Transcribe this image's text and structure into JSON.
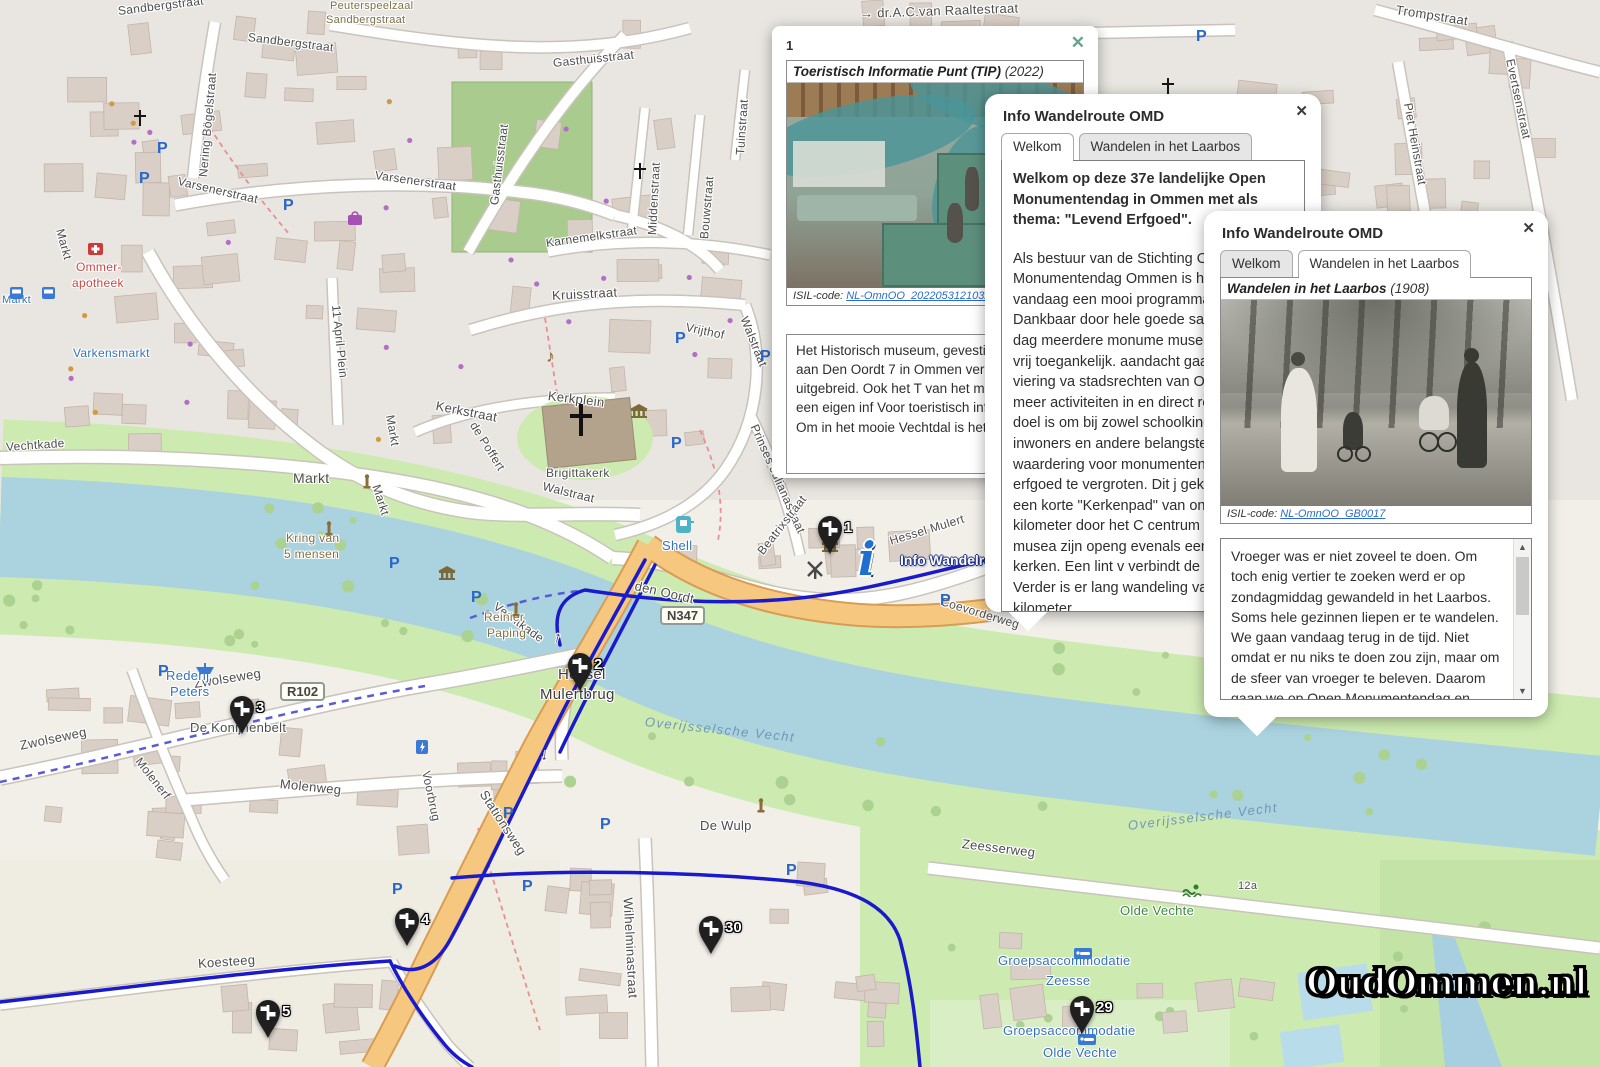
{
  "colors": {
    "route_blue": "#1a1acd",
    "road_orange": "#f6c87f",
    "water": "#aad3df",
    "marker_black": "#1f1f1f",
    "link_blue": "#2a6bd4"
  },
  "popup1": {
    "index": "1",
    "close": "✕",
    "title": "Toeristisch Informatie Punt (TIP)",
    "year": "(2022)",
    "isil_label": "ISIL-code:",
    "isil_link": "NL-OmnOO_20220531210327",
    "body": "Het Historisch museum, gevestigd i tolhuis aan Den Oordt 7 in Ommen vernieuwd en uitgebreid. Ook het T van het museum met een eigen inf Voor toeristisch informatie over Om in het mooie Vechtdal is het TIP de"
  },
  "popup2": {
    "title": "Info Wandelroute OMD",
    "close": "✕",
    "tabs": [
      "Welkom",
      "Wandelen in het Laarbos"
    ],
    "intro": "Welkom op deze 37e landelijke Open Monumentendag in Ommen met als thema: \"Levend Erfgoed\".",
    "body": "Als bestuur van de Stichting Open Monumentendag Ommen is het ons voor vandaag een mooi programma stellen. Dankbaar door hele goede sa zijn op deze dag meerdere monume musea geopend en vrij toegankelijk. aandacht gaat uit naar de viering va stadsrechten van Ommen met meer activiteiten in en direct rond het cen doel is om bij zowel schoolkinderen inwoners en andere belangstellende én waardering voor monumenten, m historisch erfgoed te vergroten. Dit j gekozen voor een korte \"Kerkenpad\" van ongeveer 2 kilometer door het C centrum waar drie musea zijn openg evenals een drietal kerken. Een lint v verbindt de kerken. Verder is er lang wandeling van ongeveer 6 kilometer"
  },
  "popup3": {
    "title": "Info Wandelroute OMD",
    "close": "✕",
    "tabs": [
      "Welkom",
      "Wandelen in het Laarbos"
    ],
    "photo_title": "Wandelen in het Laarbos",
    "photo_year": "(1908)",
    "isil_label": "ISIL-code:",
    "isil_link": "NL-OmnOO_GB0017",
    "body": "Vroeger was er niet zoveel te doen. Om toch enig vertier te zoeken werd er op zondagmiddag gewandeld in het Laarbos. Soms hele gezinnen liepen er te wandelen. We gaan vandaag terug in de tijd. Niet omdat er nu niks te doen zou zijn, maar om de sfeer van vroeger te beleven. Daarom gaan we op Open Monumentendag en Ommen 775 jaar stadsrechten wandelen in het Laarbos. Onderweg is er voldoende tijd om even uit te"
  },
  "map": {
    "logo": "OudOmmen.nl",
    "info_label": "Info Wandelroute",
    "badges": [
      {
        "t": "N347",
        "x": 660,
        "y": 606
      },
      {
        "t": "R102",
        "x": 280,
        "y": 682
      }
    ],
    "markers": [
      {
        "n": "1",
        "x": 830,
        "y": 528
      },
      {
        "n": "2",
        "x": 580,
        "y": 665
      },
      {
        "n": "3",
        "x": 242,
        "y": 708
      },
      {
        "n": "4",
        "x": 407,
        "y": 920
      },
      {
        "n": "5",
        "x": 268,
        "y": 1012
      },
      {
        "n": "29",
        "x": 1082,
        "y": 1008
      },
      {
        "n": "30",
        "x": 711,
        "y": 928
      }
    ],
    "labels": [
      {
        "t": "Sandbergstraat",
        "x": 118,
        "y": 4,
        "r": -7
      },
      {
        "t": "Sandbergstraat",
        "x": 248,
        "y": 30,
        "r": 7
      },
      {
        "t": "Peuterspeelzaal",
        "x": 330,
        "y": 0,
        "c": "olive",
        "fs": 11
      },
      {
        "t": "Sandbergstraat",
        "x": 326,
        "y": 14,
        "c": "olive",
        "fs": 11
      },
      {
        "t": "Nering Bögelstraat",
        "x": 203,
        "y": 170,
        "r": -85
      },
      {
        "t": "→ dr.A.C.van Raaltestraat",
        "x": 860,
        "y": 6,
        "r": -2,
        "fs": 13
      },
      {
        "t": "Trompstraat",
        "x": 1396,
        "y": 2,
        "r": 9,
        "fs": 13
      },
      {
        "t": "Gasthuisstraat",
        "x": 553,
        "y": 56,
        "r": -6
      },
      {
        "t": "Gasthuisstraat",
        "x": 494,
        "y": 198,
        "r": -83
      },
      {
        "t": "Tuinstraat",
        "x": 740,
        "y": 148,
        "r": -86
      },
      {
        "t": "Bouwstraat",
        "x": 704,
        "y": 232,
        "r": -85
      },
      {
        "t": "Middenstraat",
        "x": 652,
        "y": 228,
        "r": -87
      },
      {
        "t": "Varsenerstraat",
        "x": 178,
        "y": 174,
        "r": 13
      },
      {
        "t": "Varsenerstraat",
        "x": 375,
        "y": 168,
        "r": 8
      },
      {
        "t": "Karnemelkstraat",
        "x": 546,
        "y": 236,
        "r": -8
      },
      {
        "t": "Piet Heinstraat",
        "x": 1408,
        "y": 96,
        "r": 80
      },
      {
        "t": "Evertsenstraat",
        "x": 1510,
        "y": 52,
        "r": 78
      },
      {
        "t": "Kruisstraat",
        "x": 552,
        "y": 288,
        "r": -3,
        "fs": 13
      },
      {
        "t": "Vrijthof",
        "x": 686,
        "y": 320,
        "r": 12
      },
      {
        "t": "Walstraat",
        "x": 744,
        "y": 310,
        "r": 68
      },
      {
        "t": "Kerkstraat",
        "x": 436,
        "y": 398,
        "r": 11,
        "fs": 13
      },
      {
        "t": "Kerkplein",
        "x": 548,
        "y": 388,
        "r": 7,
        "fs": 13
      },
      {
        "t": "Brigittakerk",
        "x": 546,
        "y": 466
      },
      {
        "t": "Walstraat",
        "x": 543,
        "y": 479,
        "r": 14
      },
      {
        "t": "Prinses Julianastraat",
        "x": 754,
        "y": 418,
        "r": 66
      },
      {
        "t": "Beatrixstraat",
        "x": 760,
        "y": 546,
        "r": -52
      },
      {
        "t": "11 April Plein",
        "x": 336,
        "y": 298,
        "r": 84
      },
      {
        "t": "de Poffert",
        "x": 473,
        "y": 416,
        "r": 58
      },
      {
        "t": "Markt",
        "x": 60,
        "y": 222,
        "r": 75
      },
      {
        "t": "Markt",
        "x": 390,
        "y": 408,
        "r": 80
      },
      {
        "t": "Markt",
        "x": 293,
        "y": 470,
        "fs": 14
      },
      {
        "t": "Markt",
        "x": 376,
        "y": 478,
        "r": 72
      },
      {
        "t": "Markt",
        "x": 2,
        "y": 294,
        "c": "blue",
        "fs": 11
      },
      {
        "t": "Vechtkade",
        "x": 6,
        "y": 440,
        "r": -4
      },
      {
        "t": "Vechtkade",
        "x": 495,
        "y": 598,
        "r": 36
      },
      {
        "t": "Kring van",
        "x": 286,
        "y": 531,
        "c": "olive"
      },
      {
        "t": "5 mensen",
        "x": 284,
        "y": 547,
        "c": "olive"
      },
      {
        "t": "Varkensmarkt",
        "x": 73,
        "y": 346,
        "c": "blue"
      },
      {
        "t": "Ommer-",
        "x": 76,
        "y": 260,
        "c": "red"
      },
      {
        "t": "apotheek",
        "x": 72,
        "y": 276,
        "c": "red"
      },
      {
        "t": "Reinier",
        "x": 484,
        "y": 610,
        "c": "olive"
      },
      {
        "t": "Paping",
        "x": 487,
        "y": 626,
        "c": "olive"
      },
      {
        "t": "den Oordt",
        "x": 635,
        "y": 578,
        "r": 13,
        "fs": 13
      },
      {
        "t": "Shell",
        "x": 662,
        "y": 538,
        "c": "blue",
        "fs": 13
      },
      {
        "t": "Hessel Mulert",
        "x": 890,
        "y": 534,
        "r": -17
      },
      {
        "t": "Hessel",
        "x": 558,
        "y": 666,
        "fs": 15,
        "c": "dark"
      },
      {
        "t": "Mulertbrug",
        "x": 540,
        "y": 686,
        "fs": 15,
        "c": "dark"
      },
      {
        "t": "Overijsselsche Vecht",
        "x": 645,
        "y": 714,
        "r": 6,
        "c": "water",
        "fs": 13
      },
      {
        "t": "Overijsselsche Vecht",
        "x": 1128,
        "y": 818,
        "r": -7,
        "c": "water",
        "fs": 13
      },
      {
        "t": "De Wulp",
        "x": 700,
        "y": 818,
        "fs": 13
      },
      {
        "t": "Zwolseweg",
        "x": 20,
        "y": 738,
        "r": -12,
        "fs": 13
      },
      {
        "t": "Zwolseweg",
        "x": 194,
        "y": 676,
        "r": -9,
        "fs": 13
      },
      {
        "t": "Rederij",
        "x": 166,
        "y": 668,
        "c": "blue",
        "fs": 13
      },
      {
        "t": "Peters",
        "x": 170,
        "y": 684,
        "c": "blue",
        "fs": 13
      },
      {
        "t": "De Konijnenbelt",
        "x": 190,
        "y": 720,
        "fs": 13
      },
      {
        "t": "Molenerf",
        "x": 138,
        "y": 752,
        "r": 52
      },
      {
        "t": "Molenweg",
        "x": 280,
        "y": 776,
        "r": 6,
        "fs": 13
      },
      {
        "t": "Voorbrug",
        "x": 426,
        "y": 764,
        "r": 78
      },
      {
        "t": "Stationsweg",
        "x": 483,
        "y": 784,
        "r": 57,
        "fs": 13
      },
      {
        "t": "Wilhelminastraat",
        "x": 628,
        "y": 890,
        "r": 87,
        "fs": 13
      },
      {
        "t": "Koesteeg",
        "x": 198,
        "y": 956,
        "r": -4,
        "fs": 13
      },
      {
        "t": "Zeesserweg",
        "x": 962,
        "y": 836,
        "r": 7,
        "fs": 13
      },
      {
        "t": "Olde Vechte",
        "x": 1120,
        "y": 903,
        "c": "green",
        "fs": 13
      },
      {
        "t": "Groepsaccommodatie",
        "x": 998,
        "y": 953,
        "c": "blue",
        "fs": 13
      },
      {
        "t": "Zeesse",
        "x": 1046,
        "y": 973,
        "c": "blue",
        "fs": 13
      },
      {
        "t": "Groepsaccommodatie",
        "x": 1003,
        "y": 1023,
        "c": "blue",
        "fs": 13
      },
      {
        "t": "Olde Vechte",
        "x": 1043,
        "y": 1045,
        "c": "blue",
        "fs": 13
      },
      {
        "t": "12a",
        "x": 1238,
        "y": 880,
        "fs": 11
      },
      {
        "t": "Coevorderweg",
        "x": 941,
        "y": 594,
        "r": 17
      },
      {
        "t": "↑",
        "x": 554,
        "y": 628,
        "r": 15,
        "fs": 15,
        "c": "dark"
      },
      {
        "t": "↓",
        "x": 541,
        "y": 746,
        "r": 10,
        "fs": 15,
        "c": "dark"
      }
    ],
    "icons": [
      {
        "type": "parking",
        "x": 157,
        "y": 140
      },
      {
        "type": "parking",
        "x": 139,
        "y": 170
      },
      {
        "type": "parking",
        "x": 283,
        "y": 197
      },
      {
        "type": "parking",
        "x": 675,
        "y": 330
      },
      {
        "type": "parking",
        "x": 760,
        "y": 348
      },
      {
        "type": "parking",
        "x": 671,
        "y": 435
      },
      {
        "type": "parking",
        "x": 389,
        "y": 555
      },
      {
        "type": "parking",
        "x": 471,
        "y": 589
      },
      {
        "type": "parking",
        "x": 503,
        "y": 805
      },
      {
        "type": "parking",
        "x": 600,
        "y": 816
      },
      {
        "type": "parking",
        "x": 158,
        "y": 663
      },
      {
        "type": "parking",
        "x": 392,
        "y": 881
      },
      {
        "type": "parking",
        "x": 522,
        "y": 878
      },
      {
        "type": "parking",
        "x": 940,
        "y": 592
      },
      {
        "type": "parking",
        "x": 1196,
        "y": 28
      },
      {
        "type": "parking",
        "x": 786,
        "y": 862
      },
      {
        "type": "museum",
        "x": 630,
        "y": 404
      },
      {
        "type": "museum",
        "x": 438,
        "y": 566
      },
      {
        "type": "museum",
        "x": 821,
        "y": 538
      },
      {
        "type": "church",
        "x": 133,
        "y": 110
      },
      {
        "type": "church",
        "x": 633,
        "y": 163
      },
      {
        "type": "church-big",
        "x": 568,
        "y": 404
      },
      {
        "type": "church",
        "x": 1161,
        "y": 78
      },
      {
        "type": "music",
        "x": 546,
        "y": 346
      },
      {
        "type": "monument",
        "x": 362,
        "y": 474
      },
      {
        "type": "monument",
        "x": 324,
        "y": 521
      },
      {
        "type": "monument",
        "x": 511,
        "y": 602
      },
      {
        "type": "monument",
        "x": 756,
        "y": 798
      },
      {
        "type": "windmill",
        "x": 806,
        "y": 560
      },
      {
        "type": "shell",
        "x": 676,
        "y": 516
      },
      {
        "type": "pharmacy",
        "x": 88,
        "y": 241
      },
      {
        "type": "shop",
        "x": 348,
        "y": 210
      },
      {
        "type": "bus",
        "x": 10,
        "y": 286
      },
      {
        "type": "bus",
        "x": 42,
        "y": 286
      },
      {
        "type": "boat",
        "x": 196,
        "y": 662
      },
      {
        "type": "swim",
        "x": 1182,
        "y": 884
      },
      {
        "type": "charging",
        "x": 416,
        "y": 740
      },
      {
        "type": "bed",
        "x": 1074,
        "y": 946
      },
      {
        "type": "bed",
        "x": 1078,
        "y": 1032
      }
    ]
  }
}
